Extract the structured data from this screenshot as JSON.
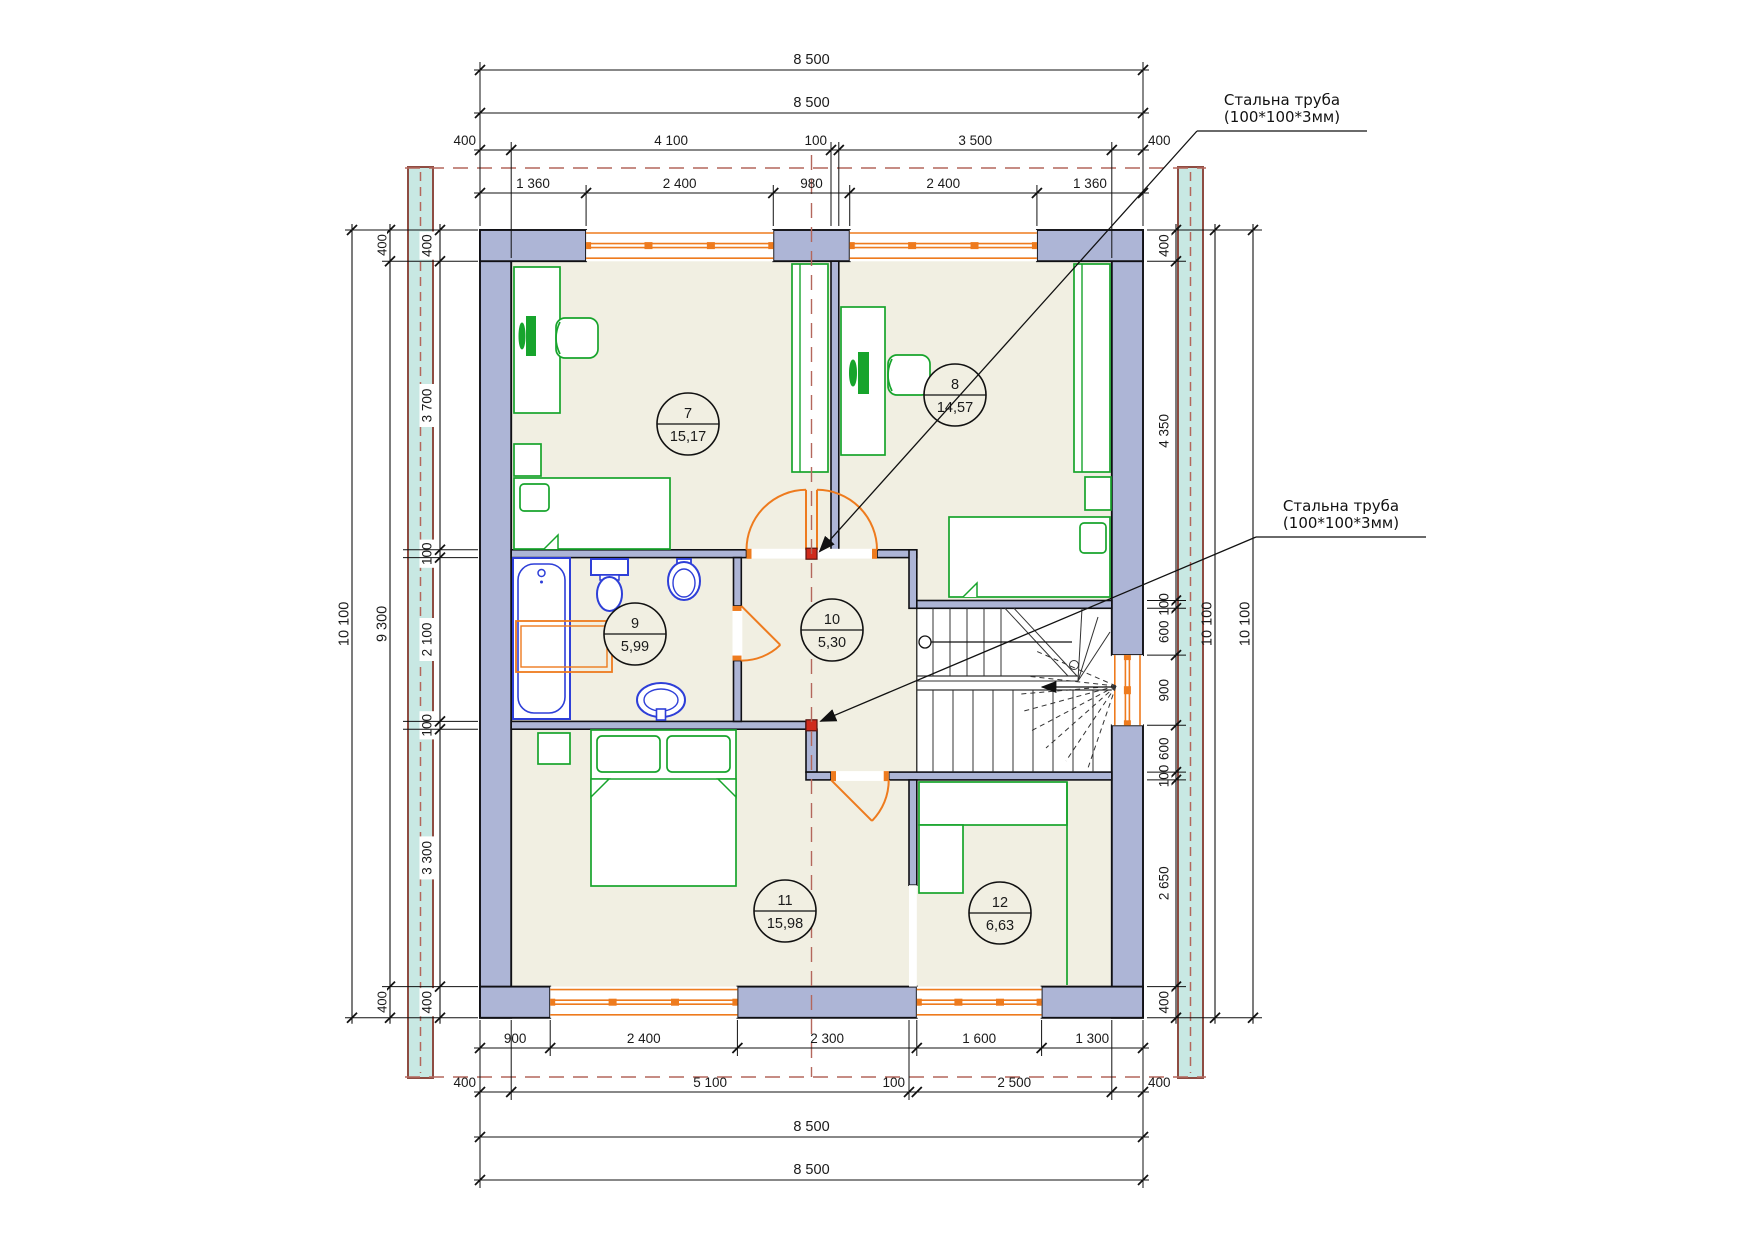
{
  "drawing_type": "floor-plan",
  "annotations": [
    {
      "id": "steel-pipe-1",
      "line1": "Стальна труба",
      "line2": "(100*100*3мм)"
    },
    {
      "id": "steel-pipe-2",
      "line1": "Стальна труба",
      "line2": "(100*100*3мм)"
    }
  ],
  "rooms": [
    {
      "number": "7",
      "area": "15,17"
    },
    {
      "number": "8",
      "area": "14,57"
    },
    {
      "number": "9",
      "area": "5,99"
    },
    {
      "number": "10",
      "area": "5,30"
    },
    {
      "number": "11",
      "area": "15,98"
    },
    {
      "number": "12",
      "area": "6,63"
    }
  ],
  "dimensions": {
    "top": {
      "overall_1": "8 500",
      "overall_2": "8 500",
      "chain_walls": [
        "400",
        "4 100",
        "100",
        "3 500",
        "400"
      ],
      "chain_openings": [
        "1 360",
        "2 400",
        "980",
        "2 400",
        "1 360"
      ]
    },
    "bottom": {
      "chain_openings": [
        "900",
        "2 400",
        "2 300",
        "1 600",
        "1 300"
      ],
      "chain_walls": [
        "400",
        "5 100",
        "100",
        "2 500",
        "400"
      ],
      "overall_1": "8 500",
      "overall_2": "8 500"
    },
    "left": {
      "overall": "10 100",
      "inner": "9 300",
      "chain": [
        "400",
        "3 700",
        "100",
        "2 100",
        "100",
        "3 300",
        "400"
      ]
    },
    "right": {
      "chain": [
        "400",
        "4 350",
        "100",
        "600",
        "900",
        "600",
        "100",
        "2 650",
        "400"
      ],
      "overall_1": "10 100",
      "overall_2": "10 100"
    }
  },
  "colors": {
    "wall_fill": "#adb5d6",
    "wall_stroke": "#101014",
    "floor": "#f1efe2",
    "furniture_green": "#17a42c",
    "fixture_blue": "#2e3fd8",
    "window_orange": "#ee7b1e",
    "axis_red": "#b4675c",
    "strip_fill": "#c8e8e3",
    "strip_border": "#8e4c42",
    "column_red": "#cf2b1d",
    "dim_text": "#1a1a1a",
    "stair_line": "#333333"
  }
}
